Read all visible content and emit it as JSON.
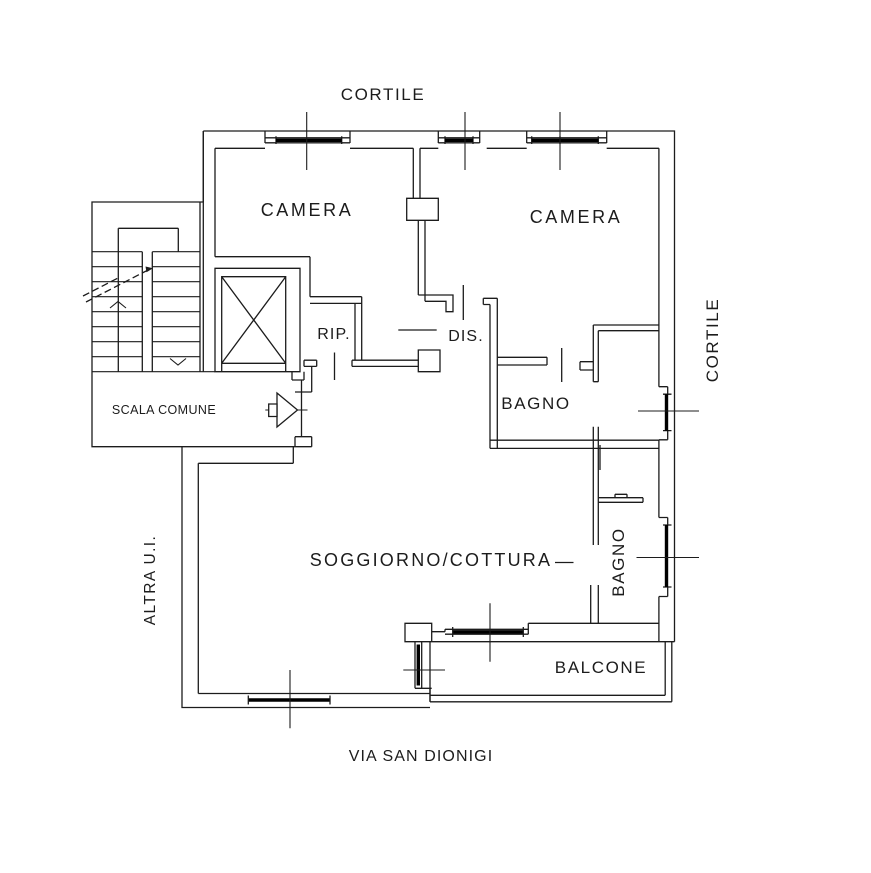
{
  "plan": {
    "background": "#ffffff",
    "line_color": "#1c1c1c",
    "window_band_color": "#000000",
    "labels": {
      "cortile_top": "CORTILE",
      "cortile_right": "CORTILE",
      "camera_left": "CAMERA",
      "camera_right": "CAMERA",
      "rip": "RIP.",
      "dis": "DIS.",
      "bagno_upper": "BAGNO",
      "bagno_lower": "BAGNO",
      "soggiorno": "SOGGIORNO/COTTURA",
      "balcone": "BALCONE",
      "scala_comune": "SCALA COMUNE",
      "altra_ui": "ALTRA U.I.",
      "via_bottom": "VIA SAN DIONIGI"
    }
  }
}
